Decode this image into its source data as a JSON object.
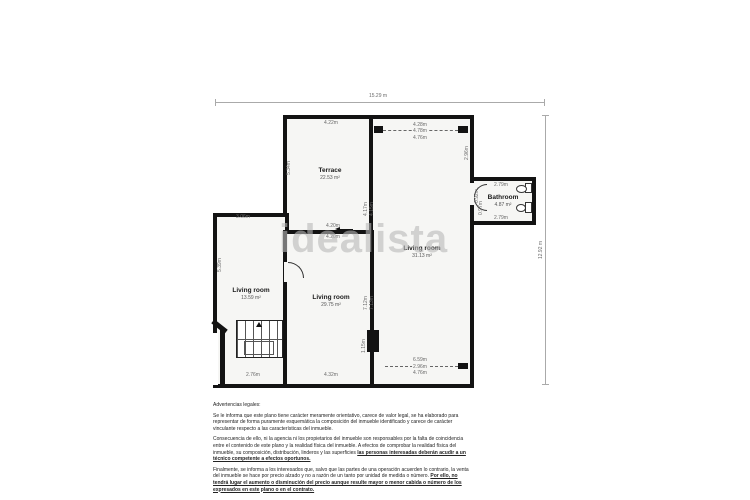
{
  "watermark": "idealista",
  "plan": {
    "rooms": {
      "terrace": {
        "name": "Terrace",
        "area": "22.53 m²"
      },
      "living_right": {
        "name": "Living room",
        "area": "31.13 m²"
      },
      "bathroom": {
        "name": "Bathroom",
        "area": "4.87 m²"
      },
      "living_left": {
        "name": "Living room",
        "area": "13.59 m²"
      },
      "living_center": {
        "name": "Living room",
        "area": "29.75 m²"
      }
    },
    "overall": {
      "top_width": "15.29 m",
      "right_height": "12.92 m"
    },
    "dims": {
      "terrace_top": "4.22m",
      "terrace_left": "5.34m",
      "terrace_bottom_a": "4.20m",
      "terrace_bottom_b": "4.20m",
      "divider_upper_a": "4.17m",
      "divider_upper_b": "4.15m",
      "right_top_a": "4.28m",
      "right_top_b": "4.78m",
      "right_top_c": "4.76m",
      "right_side_upper": "2.96m",
      "bath_top": "2.79m",
      "bath_bottom": "2.79m",
      "bath_door_a": "0.92m",
      "bath_door_b": "0.97m",
      "left_top": "3.06m",
      "left_side": "5.39m",
      "divider_lower_a": "7.12m",
      "divider_lower_b": "7.13m",
      "stairs_bottom": "2.76m",
      "center_bottom": "4.32m",
      "pillar_side": "1.15m",
      "bottom_a": "6.59m",
      "bottom_b": "2.96m",
      "bottom_c": "4.76m"
    }
  },
  "legal": {
    "title": "Advertencias legales:",
    "paragraphs": [
      {
        "text": "Se le informa que este plano tiene carácter meramente orientativo, carece de valor legal, se ha elaborado para representar de forma puramente esquemática la composición del inmueble identificado y carece de carácter vinculante respecto a las características del inmueble.",
        "emph": ""
      },
      {
        "text": "Consecuencia de ello, ni la agencia ni los propietarios del inmueble son responsables por la falta de coincidencia entre el contenido de este plano y la realidad física del inmueble. A efectos de comprobar la realidad física del inmueble, su composición, distribución, linderos y las superficies ",
        "emph": "las personas interesadas deberán acudir a un técnico competente a efectos oportunos."
      },
      {
        "text": "Finalmente, se informa a los interesados que, salvo que las partes de una operación acuerden lo contrario, la venta del inmueble se hace por precio alzado y no a razón de un tanto por unidad de medida o número. ",
        "emph": "Por ello, no tendrá lugar el aumento o disminución del precio aunque resulte mayor o menor cabida o número de los expresados en este plano o en el contrato."
      }
    ]
  }
}
